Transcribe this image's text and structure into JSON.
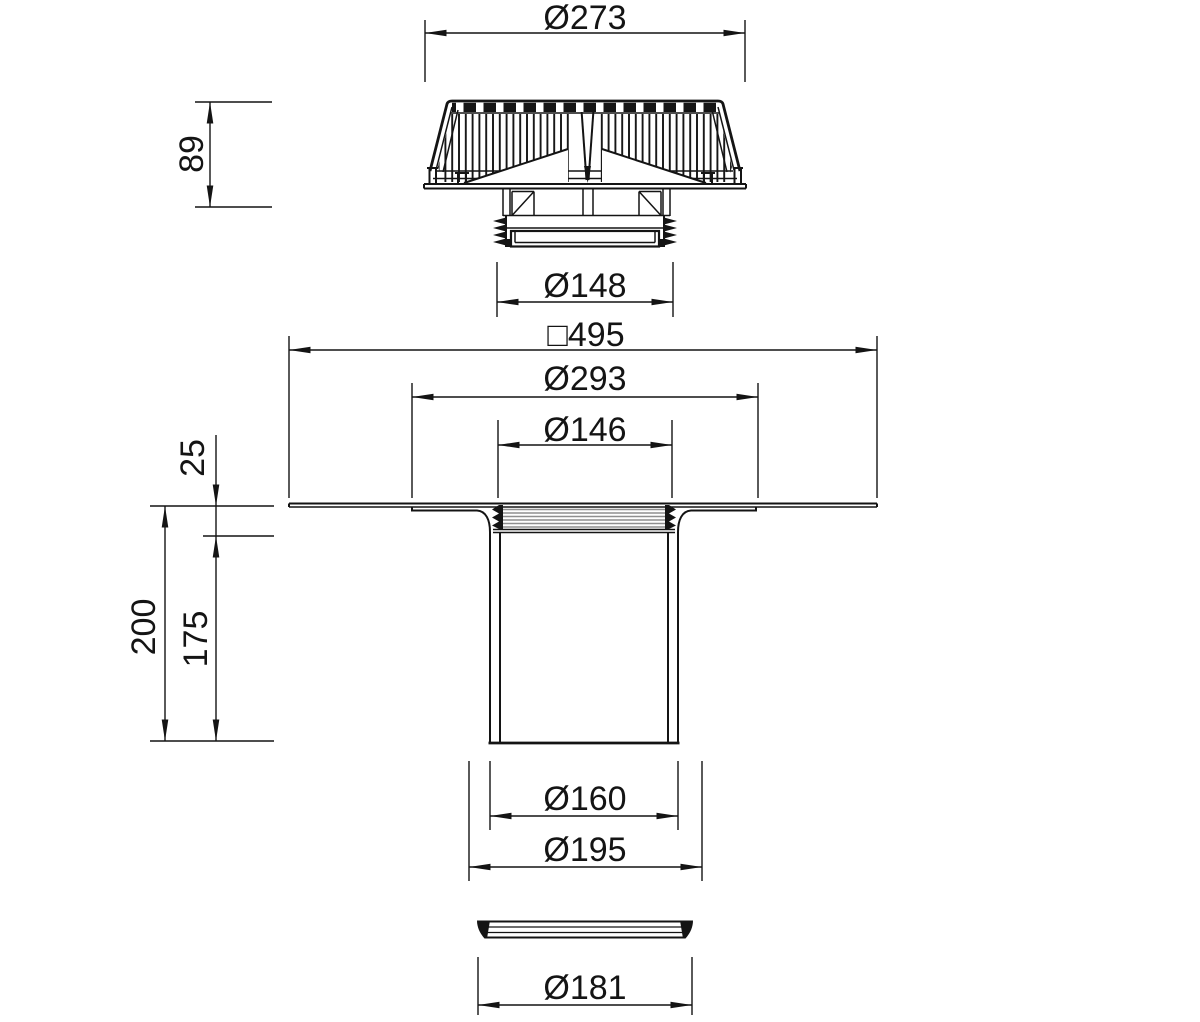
{
  "drawing": {
    "background": "#ffffff",
    "line_color": "#141414",
    "hatch_color": "#8f8f8f",
    "views": {
      "top": {
        "label": "strainer-side-view",
        "dimensions": {
          "outer_diameter": "Ø273",
          "height": "89",
          "thread_diameter": "Ø148"
        }
      },
      "section": {
        "label": "drain-body-section-view",
        "dimensions": {
          "flange_square": "□495",
          "recess_diameter": "Ø293",
          "throat_diameter": "Ø146",
          "flange_height": "25",
          "total_depth": "200",
          "spigot_depth": "175",
          "pipe_diameter": "Ø160",
          "collar_diameter": "Ø195",
          "seal_diameter": "Ø181"
        }
      }
    }
  }
}
